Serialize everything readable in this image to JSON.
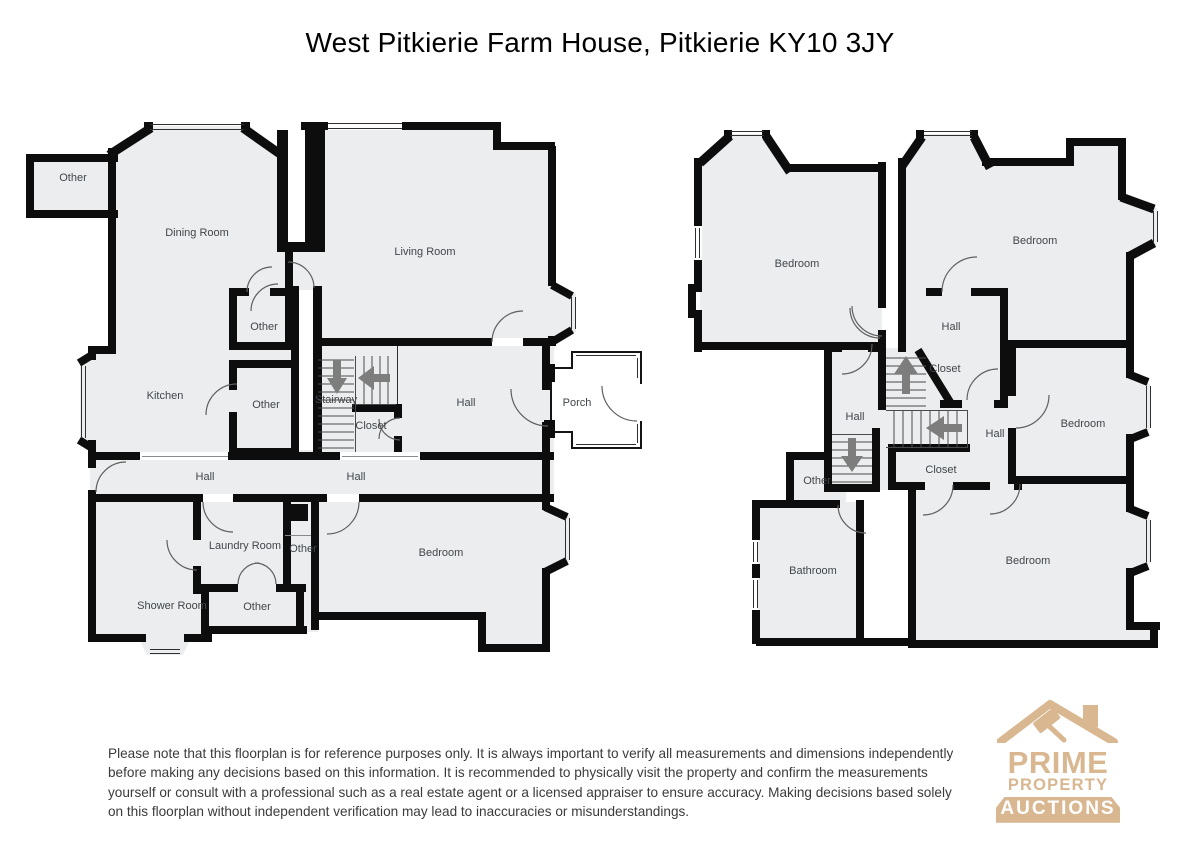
{
  "title": "West Pitkierie Farm House, Pitkierie KY10 3JY",
  "floors": [
    {
      "id": "ground-floor",
      "rooms": [
        {
          "label": "Other",
          "x": 73,
          "y": 178
        },
        {
          "label": "Dining Room",
          "x": 197,
          "y": 233
        },
        {
          "label": "Living Room",
          "x": 425,
          "y": 252
        },
        {
          "label": "Other",
          "x": 264,
          "y": 327
        },
        {
          "label": "Kitchen",
          "x": 165,
          "y": 396
        },
        {
          "label": "Other",
          "x": 266,
          "y": 405
        },
        {
          "label": "Stairway",
          "x": 336,
          "y": 400
        },
        {
          "label": "Closet",
          "x": 371,
          "y": 426
        },
        {
          "label": "Hall",
          "x": 466,
          "y": 403
        },
        {
          "label": "Porch",
          "x": 577,
          "y": 403
        },
        {
          "label": "Hall",
          "x": 205,
          "y": 477
        },
        {
          "label": "Hall",
          "x": 356,
          "y": 477
        },
        {
          "label": "Laundry Room",
          "x": 245,
          "y": 546
        },
        {
          "label": "Other",
          "x": 303,
          "y": 549
        },
        {
          "label": "Shower Room",
          "x": 172,
          "y": 606
        },
        {
          "label": "Other",
          "x": 257,
          "y": 607
        },
        {
          "label": "Bedroom",
          "x": 441,
          "y": 553
        }
      ]
    },
    {
      "id": "first-floor",
      "rooms": [
        {
          "label": "Bedroom",
          "x": 797,
          "y": 264
        },
        {
          "label": "Bedroom",
          "x": 1035,
          "y": 241
        },
        {
          "label": "Hall",
          "x": 951,
          "y": 327
        },
        {
          "label": "Closet",
          "x": 945,
          "y": 369
        },
        {
          "label": "Hall",
          "x": 855,
          "y": 417
        },
        {
          "label": "Hall",
          "x": 995,
          "y": 434
        },
        {
          "label": "Bedroom",
          "x": 1083,
          "y": 424
        },
        {
          "label": "Closet",
          "x": 941,
          "y": 470
        },
        {
          "label": "Other",
          "x": 817,
          "y": 481
        },
        {
          "label": "Bathroom",
          "x": 813,
          "y": 571
        },
        {
          "label": "Bedroom",
          "x": 1028,
          "y": 561
        }
      ]
    }
  ],
  "disclaimer": "Please note that this floorplan is for reference purposes only. It is always important to verify all measurements and dimensions independently before making any decisions based on this information. It is recommended to physically visit the property and confirm the measurements yourself or consult with a professional such as a real estate agent or a licensed appraiser to ensure accuracy. Making decisions based solely on this floorplan without independent verification may lead to inaccuracies or misunderstandings.",
  "logo": {
    "name": "Prime Property Auctions",
    "line1": "PRIME",
    "line2": "PROPERTY",
    "line3": "AUCTIONS",
    "color": "#D8B791"
  },
  "colors": {
    "room_fill": "#ECEDEE",
    "wall": "#0D0D0D",
    "label_text": "#41464B",
    "stair_arrow": "#7D7D7D",
    "logo_tan": "#D8B791",
    "banner_text": "#FFFFFF"
  }
}
